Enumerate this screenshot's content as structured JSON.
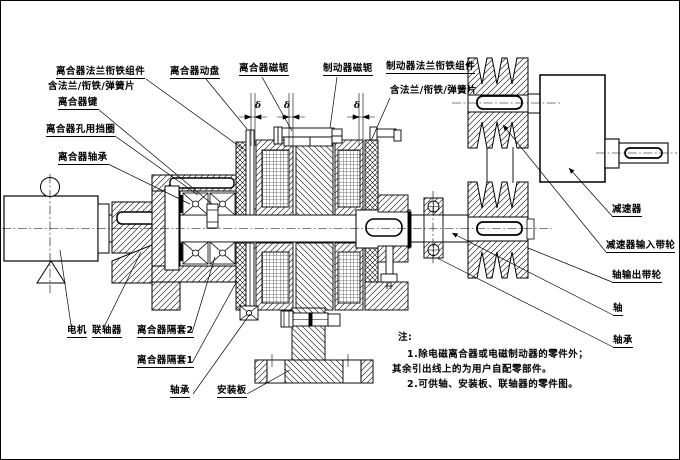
{
  "drawing": {
    "kind": "electromagnetic-clutch-brake-assembly-section",
    "colors": {
      "ink": "#000000",
      "paper": "#ffffff"
    }
  },
  "labels": {
    "clutch_flange_armature": "离合器法兰衔铁组件",
    "clutch_flange_sub": "含法兰/衔铁/弹簧片",
    "clutch_key": "离合器键",
    "clutch_bore_ring": "离合器孔用挡圈",
    "clutch_bearing": "离合器轴承",
    "clutch_disc": "离合器动盘",
    "clutch_yoke": "离合器磁轭",
    "brake_yoke": "制动器磁轭",
    "brake_flange_armature": "制动器法兰衔铁组件",
    "brake_flange_sub": "含法兰/衔铁/弹簧片",
    "reducer": "减速器",
    "reducer_input_pulley": "减速器输入带轮",
    "shaft_output_pulley": "轴输出带轮",
    "shaft": "轴",
    "bearing_right": "轴承",
    "motor": "电机",
    "coupling": "联轴器",
    "clutch_spacer2": "离合器隔套2",
    "clutch_spacer1": "离合器隔套1",
    "bearing_bottom": "轴承",
    "mounting_plate": "安装板"
  },
  "notes": {
    "title": "注:",
    "line1": "1.除电磁离合器或电磁制动器的零件外；",
    "line2": "其余引出线上的为用户自配零部件。",
    "line3": "2.可供轴、安装板、联轴器的零件图。"
  },
  "symbols": {
    "gap_delta": "δ"
  }
}
